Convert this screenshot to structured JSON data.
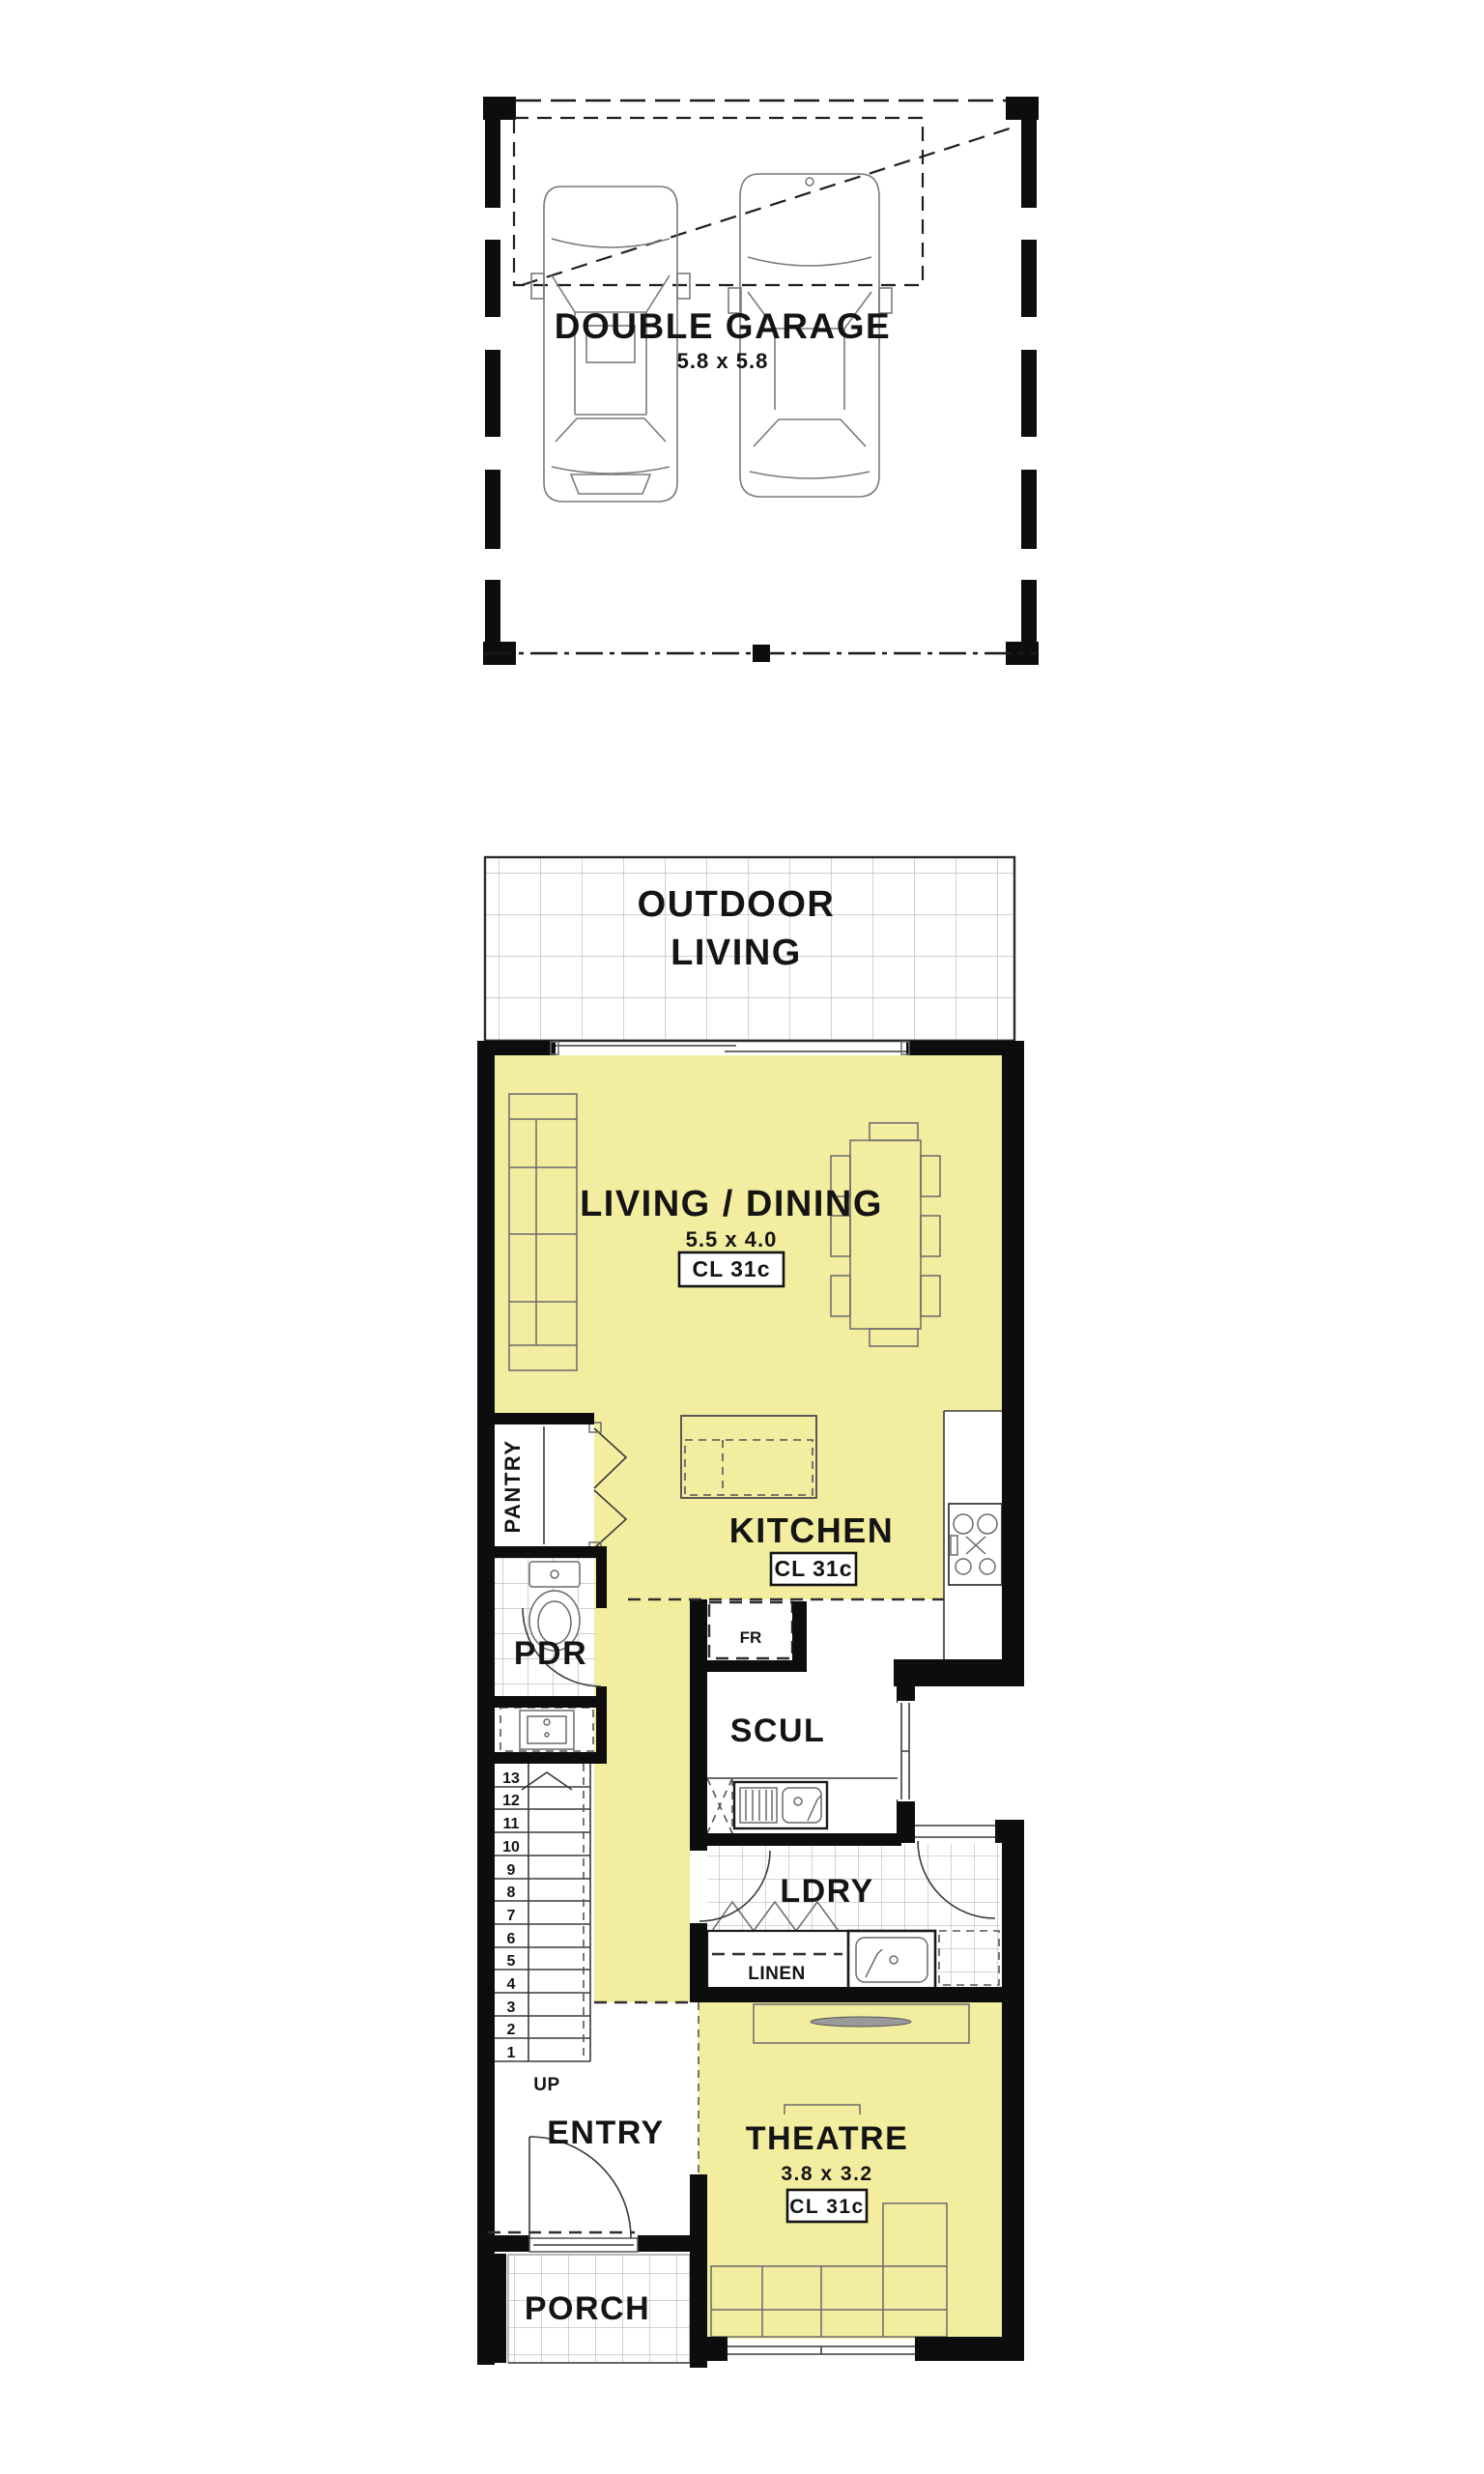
{
  "colors": {
    "room_fill": "#F3EDA0",
    "wall": "#0D0D0D",
    "tile_grid": "#BFBFBF"
  },
  "garage": {
    "name": "DOUBLE GARAGE",
    "dims": "5.8 x 5.8"
  },
  "rooms": {
    "outdoor_living": {
      "line1": "OUTDOOR",
      "line2": "LIVING"
    },
    "living_dining": {
      "name": "LIVING / DINING",
      "dims": "5.5 x 4.0",
      "ceiling": "CL 31c"
    },
    "kitchen": {
      "name": "KITCHEN",
      "ceiling": "CL 31c"
    },
    "pantry": {
      "name": "PANTRY"
    },
    "pdr": {
      "name": "PDR"
    },
    "scullery": {
      "name": "SCUL"
    },
    "laundry": {
      "name": "LDRY"
    },
    "linen": {
      "name": "LINEN"
    },
    "fridge": {
      "name": "FR"
    },
    "entry": {
      "name": "ENTRY"
    },
    "porch": {
      "name": "PORCH"
    },
    "theatre": {
      "name": "THEATRE",
      "dims": "3.8 x 3.2",
      "ceiling": "CL 31c"
    },
    "stairs": {
      "up": "UP",
      "numbers": [
        "13",
        "12",
        "11",
        "10",
        "9",
        "8",
        "7",
        "6",
        "5",
        "4",
        "3",
        "2",
        "1"
      ]
    }
  }
}
